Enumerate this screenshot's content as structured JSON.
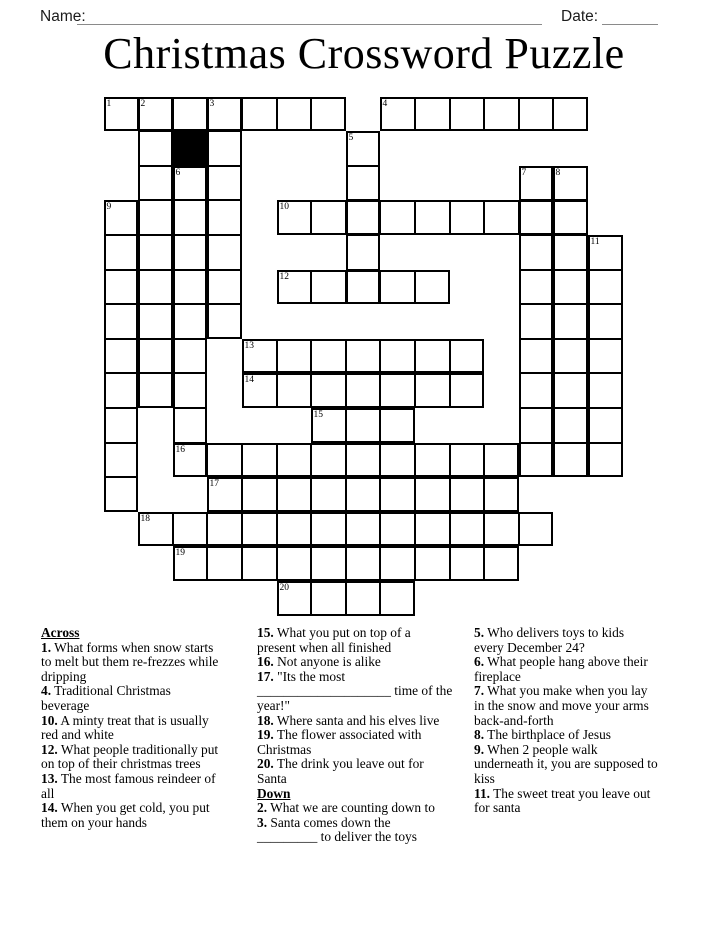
{
  "header": {
    "name_label": "Name:",
    "date_label": "Date:"
  },
  "title": "Christmas Crossword Puzzle",
  "colors": {
    "ink": "#000000",
    "write_line_gray": "#8a8a8a",
    "black_cell": "#000000",
    "paper": "#ffffff"
  },
  "grid": {
    "rows": 15,
    "cols": 15,
    "numbers": [
      {
        "n": "1",
        "r": 0,
        "c": 0
      },
      {
        "n": "2",
        "r": 0,
        "c": 1
      },
      {
        "n": "3",
        "r": 0,
        "c": 3
      },
      {
        "n": "4",
        "r": 0,
        "c": 8
      },
      {
        "n": "5",
        "r": 1,
        "c": 7
      },
      {
        "n": "6",
        "r": 2,
        "c": 2
      },
      {
        "n": "7",
        "r": 2,
        "c": 12
      },
      {
        "n": "8",
        "r": 2,
        "c": 13
      },
      {
        "n": "9",
        "r": 3,
        "c": 0
      },
      {
        "n": "10",
        "r": 3,
        "c": 5
      },
      {
        "n": "11",
        "r": 4,
        "c": 14
      },
      {
        "n": "12",
        "r": 5,
        "c": 5
      },
      {
        "n": "13",
        "r": 7,
        "c": 4
      },
      {
        "n": "14",
        "r": 8,
        "c": 4
      },
      {
        "n": "15",
        "r": 9,
        "c": 6
      },
      {
        "n": "16",
        "r": 10,
        "c": 2
      },
      {
        "n": "17",
        "r": 11,
        "c": 3
      },
      {
        "n": "18",
        "r": 12,
        "c": 1
      },
      {
        "n": "19",
        "r": 13,
        "c": 2
      },
      {
        "n": "20",
        "r": 14,
        "c": 5
      }
    ],
    "black_cells": [
      {
        "r": 1,
        "c": 2
      }
    ],
    "across_words": [
      {
        "row": 0,
        "c1": 0,
        "c2": 6
      },
      {
        "row": 0,
        "c1": 8,
        "c2": 13
      },
      {
        "row": 3,
        "c1": 5,
        "c2": 13
      },
      {
        "row": 5,
        "c1": 5,
        "c2": 9
      },
      {
        "row": 7,
        "c1": 4,
        "c2": 10
      },
      {
        "row": 8,
        "c1": 4,
        "c2": 10
      },
      {
        "row": 9,
        "c1": 6,
        "c2": 8
      },
      {
        "row": 10,
        "c1": 2,
        "c2": 11
      },
      {
        "row": 11,
        "c1": 3,
        "c2": 11
      },
      {
        "row": 12,
        "c1": 1,
        "c2": 12
      },
      {
        "row": 13,
        "c1": 2,
        "c2": 11
      },
      {
        "row": 14,
        "c1": 5,
        "c2": 8
      }
    ],
    "down_words": [
      {
        "col": 0,
        "r1": 3,
        "r2": 11
      },
      {
        "col": 1,
        "r1": 0,
        "r2": 8
      },
      {
        "col": 2,
        "r1": 2,
        "r2": 10
      },
      {
        "col": 3,
        "r1": 0,
        "r2": 6
      },
      {
        "col": 7,
        "r1": 1,
        "r2": 5
      },
      {
        "col": 12,
        "r1": 2,
        "r2": 10
      },
      {
        "col": 13,
        "r1": 2,
        "r2": 10
      },
      {
        "col": 14,
        "r1": 4,
        "r2": 10
      }
    ]
  },
  "clues": {
    "columns": [
      {
        "items": [
          {
            "header": "Across"
          },
          {
            "num": "1.",
            "text": "What forms when snow starts\nto melt but them re-frezzes while\ndripping"
          },
          {
            "num": "4.",
            "text": "Traditional Christmas\nbeverage"
          },
          {
            "num": "10.",
            "text": "A minty treat that is usually\nred and white"
          },
          {
            "num": "12.",
            "text": "What people traditionally put\non top of their christmas trees"
          },
          {
            "num": "13.",
            "text": "The most famous reindeer of\nall"
          },
          {
            "num": "14.",
            "text": "When you get cold, you put\nthem on your hands"
          }
        ]
      },
      {
        "items": [
          {
            "num": "15.",
            "text": "What you put on top of a\npresent when all finished"
          },
          {
            "num": "16.",
            "text": "Not anyone is alike"
          },
          {
            "num": "17.",
            "text": "\"Its the most\n____________________ time of the\nyear!\""
          },
          {
            "num": "18.",
            "text": "Where santa and his elves live"
          },
          {
            "num": "19.",
            "text": "The flower associated with\nChristmas"
          },
          {
            "num": "20.",
            "text": "The drink you leave out for\nSanta"
          },
          {
            "header": "Down"
          },
          {
            "num": "2.",
            "text": "What we are counting down to"
          },
          {
            "num": "3.",
            "text": "Santa comes down the\n_________ to deliver the toys"
          }
        ]
      },
      {
        "items": [
          {
            "num": "5.",
            "text": "Who delivers toys to kids\nevery December 24?"
          },
          {
            "num": "6.",
            "text": "What people hang above their\nfireplace"
          },
          {
            "num": "7.",
            "text": "What you make when you lay\nin the snow and move your arms\nback-and-forth"
          },
          {
            "num": "8.",
            "text": "The birthplace of Jesus"
          },
          {
            "num": "9.",
            "text": "When 2 people walk\nunderneath it, you are supposed to\nkiss"
          },
          {
            "num": "11.",
            "text": "The sweet treat you leave out\nfor santa"
          }
        ]
      }
    ]
  }
}
